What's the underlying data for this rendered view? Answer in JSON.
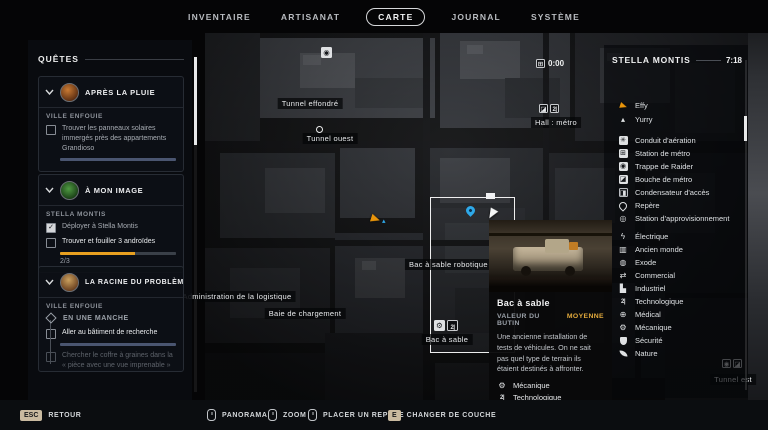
{
  "nav": {
    "items": [
      {
        "label": "INVENTAIRE"
      },
      {
        "label": "ARTISANAT"
      },
      {
        "label": "CARTE",
        "active": true
      },
      {
        "label": "JOURNAL"
      },
      {
        "label": "SYSTÈME"
      }
    ]
  },
  "quests": {
    "header": "QUÊTES",
    "cards": [
      {
        "title": "APRÈS LA PLUIE",
        "location": "VILLE ENFOUIE",
        "objectives": [
          {
            "text": "Trouver les panneaux solaires immergés près des appartements Grandioso",
            "checked": false,
            "progress": 100
          }
        ]
      },
      {
        "title": "À MON IMAGE",
        "location": "STELLA MONTIS",
        "objectives": [
          {
            "text": "Déployer à Stella Montis",
            "checked": true
          },
          {
            "text": "Trouver et fouiller 3 androïdes",
            "checked": false,
            "progress": 65,
            "counter": "2/3"
          }
        ]
      },
      {
        "title": "LA RACINE DU PROBLÈME",
        "location": "VILLE ENFOUIE",
        "stage": "EN UNE MANCHE",
        "objectives": [
          {
            "text": "Aller au bâtiment de recherche",
            "checked": false,
            "progress": 100
          },
          {
            "text": "Chercher le coffre à graines dans la « pièce avec une vue imprenable »",
            "checked": false,
            "faded": true
          }
        ]
      }
    ]
  },
  "map": {
    "labels": [
      "Tunnel effondré",
      "Tunnel ouest",
      "Hall : métro",
      "Bac à sable robotique A",
      "Administration de la logistique",
      "Baie de chargement",
      "Bac à sable",
      "Tunnel est"
    ],
    "metro_timer": "0:00"
  },
  "legend": {
    "title": "STELLA MONTIS",
    "time": "7:18",
    "markers": [
      {
        "icon": "player-arrow-icon",
        "label": "Effy"
      },
      {
        "icon": "ally-triangle-icon",
        "label": "Yurry"
      },
      {
        "icon": "vent-icon",
        "label": "Conduit d'aération"
      },
      {
        "icon": "metro-station-icon",
        "label": "Station de métro"
      },
      {
        "icon": "raider-hatch-icon",
        "label": "Trappe de Raider"
      },
      {
        "icon": "metro-entrance-icon",
        "label": "Bouche de métro"
      },
      {
        "icon": "access-capacitor-icon",
        "label": "Condensateur d'accès"
      },
      {
        "icon": "waypoint-pin-icon",
        "label": "Repère"
      },
      {
        "icon": "supply-station-icon",
        "label": "Station d'approvisionnement"
      }
    ],
    "categories": [
      {
        "icon": "electric-icon",
        "label": "Électrique"
      },
      {
        "icon": "ancient-world-icon",
        "label": "Ancien monde"
      },
      {
        "icon": "exodus-icon",
        "label": "Exode"
      },
      {
        "icon": "commercial-icon",
        "label": "Commercial"
      },
      {
        "icon": "industrial-icon",
        "label": "Industriel"
      },
      {
        "icon": "technology-icon",
        "label": "Technologique"
      },
      {
        "icon": "medical-icon",
        "label": "Médical"
      },
      {
        "icon": "mechanical-icon",
        "label": "Mécanique"
      },
      {
        "icon": "security-icon",
        "label": "Sécurité"
      },
      {
        "icon": "nature-icon",
        "label": "Nature"
      }
    ]
  },
  "tooltip": {
    "title": "Bac à sable",
    "loot_label": "VALEUR DU BUTIN",
    "loot_value": "MOYENNE",
    "description": "Une ancienne installation de tests de véhicules. On ne sait pas quel type de terrain ils étaient destinés à affronter.",
    "tags": [
      "Mécanique",
      "Technologique"
    ]
  },
  "bottom_bar": {
    "actions": [
      {
        "key": "ESC",
        "label": "RETOUR"
      },
      {
        "icon": "mouse-icon",
        "label": "PANORAMA"
      },
      {
        "icon": "mouse-wheel-icon",
        "label": "ZOOM"
      },
      {
        "icon": "mouse-icon",
        "label": "PLACER UN REPÈRE"
      },
      {
        "key": "E",
        "label": "CHANGER DE COUCHE"
      }
    ]
  },
  "colors": {
    "accent-gold": "#e3aa3c",
    "progress-slate": "#4a5570",
    "progress-amber": "#e8a020",
    "marker-blue": "#2ea8e8",
    "player-orange": "#e8940a",
    "key-badge": "#c9baa0"
  }
}
